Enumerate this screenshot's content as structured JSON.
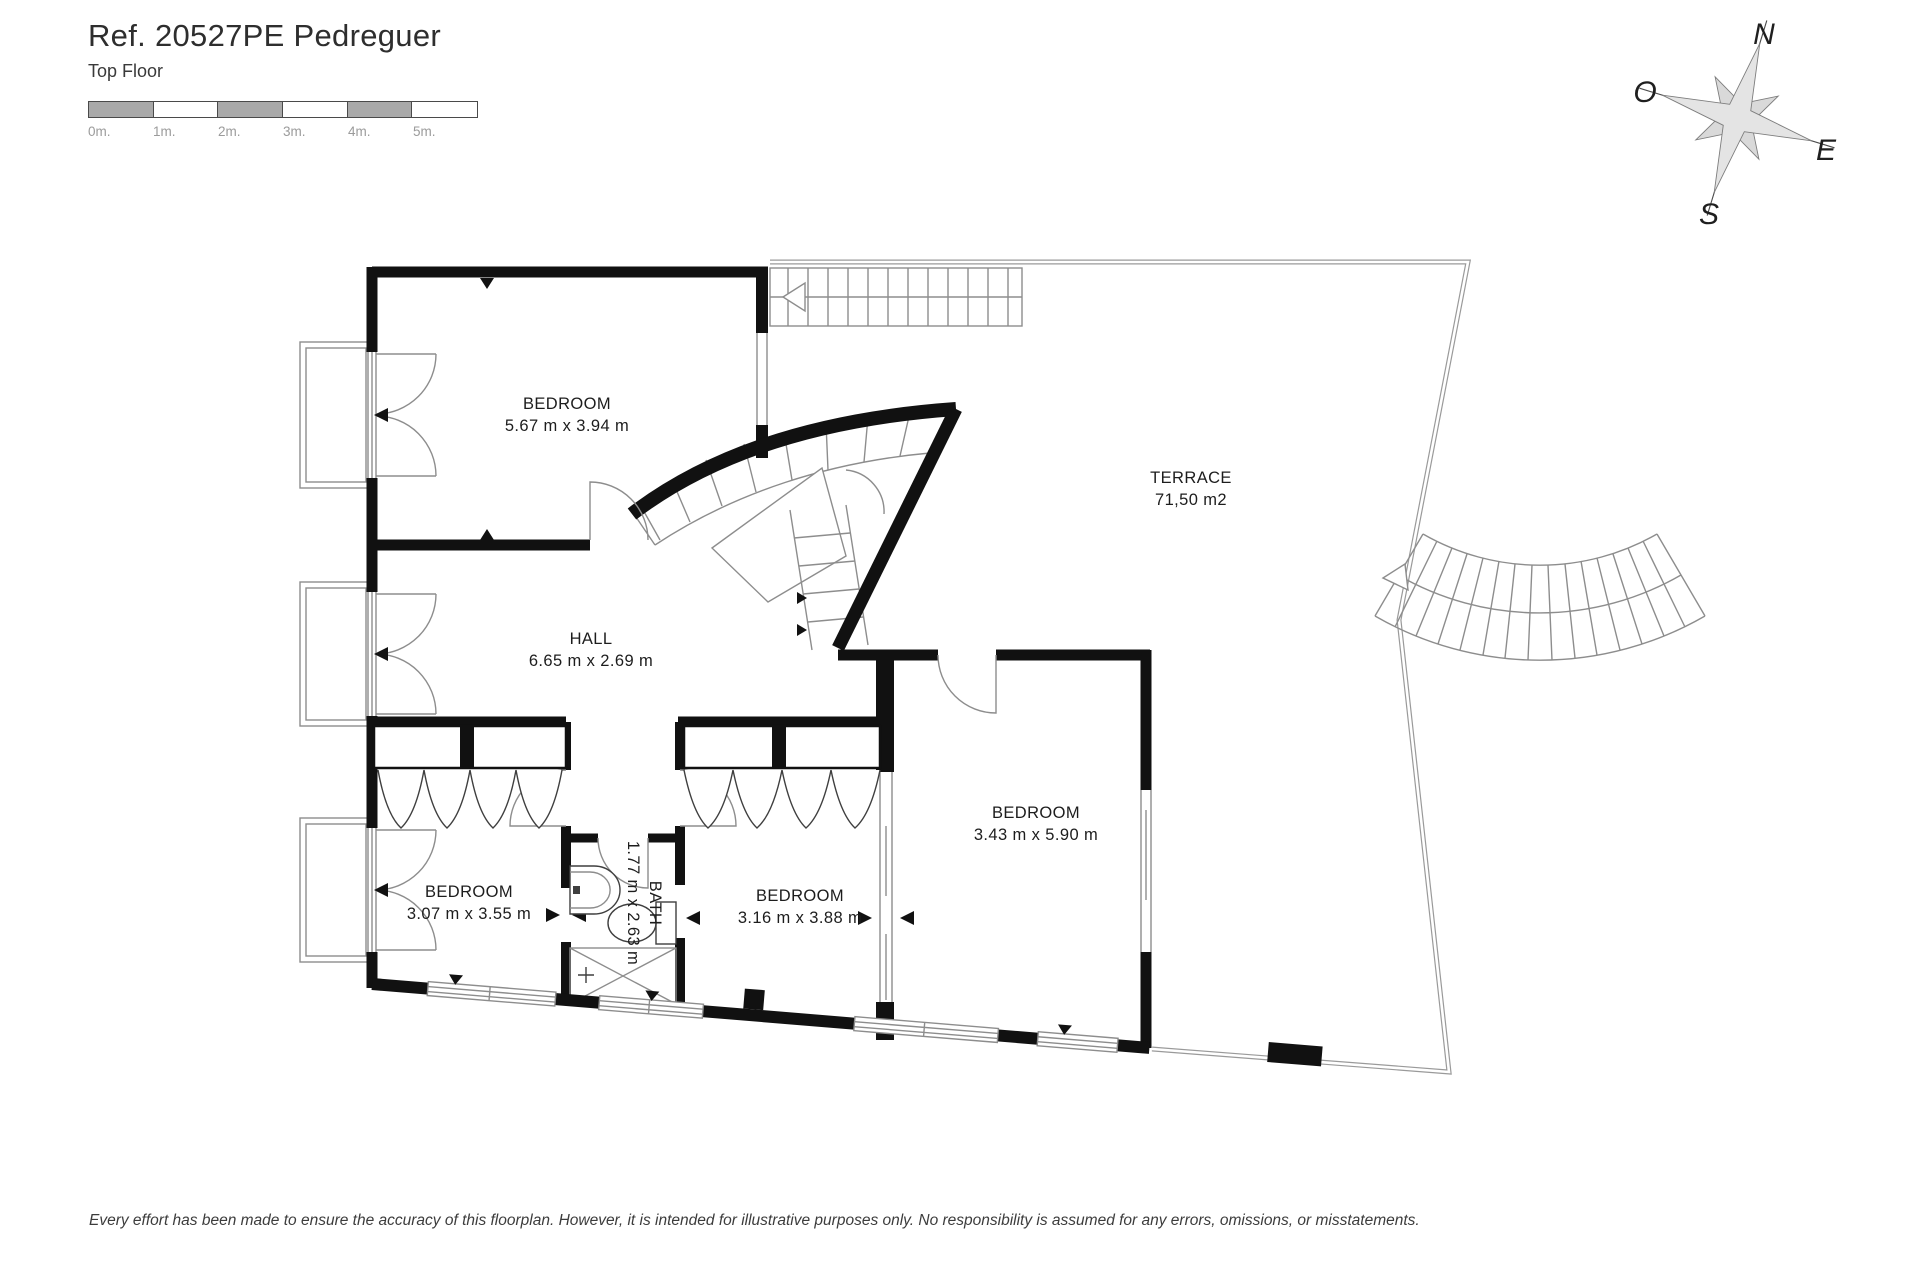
{
  "header": {
    "reference": "Ref. 20527PE Pedreguer",
    "floor": "Top Floor"
  },
  "scale_bar": {
    "labels": [
      "0m.",
      "1m.",
      "2m.",
      "3m.",
      "4m.",
      "5m."
    ]
  },
  "compass": {
    "north": "N",
    "west": "O",
    "east": "E",
    "south": "S"
  },
  "rooms": [
    {
      "name": "BEDROOM",
      "dims": "5.67 m x 3.94 m"
    },
    {
      "name": "TERRACE",
      "dims": "71,50 m2"
    },
    {
      "name": "HALL",
      "dims": "6.65 m x 2.69 m"
    },
    {
      "name": "BEDROOM",
      "dims": "3.07 m x 3.55 m"
    },
    {
      "name": "BATH",
      "dims": "1.77 m x 2.63 m"
    },
    {
      "name": "BEDROOM",
      "dims": "3.16 m x 3.88 m"
    },
    {
      "name": "BEDROOM",
      "dims": "3.43 m x 5.90 m"
    }
  ],
  "footer": {
    "disclaimer": "Every effort has been made to ensure the accuracy of this floorplan. However, it is intended for illustrative purposes only. No responsibility is assumed for any errors, omissions, or misstatements."
  },
  "colors": {
    "wall": "#111111",
    "thin_line": "#8d8d8d",
    "scale_gray": "#a9a9a9",
    "text": "#1d1d1d",
    "muted": "#9b9b9b",
    "compass_fill": "#d9d9d9"
  }
}
